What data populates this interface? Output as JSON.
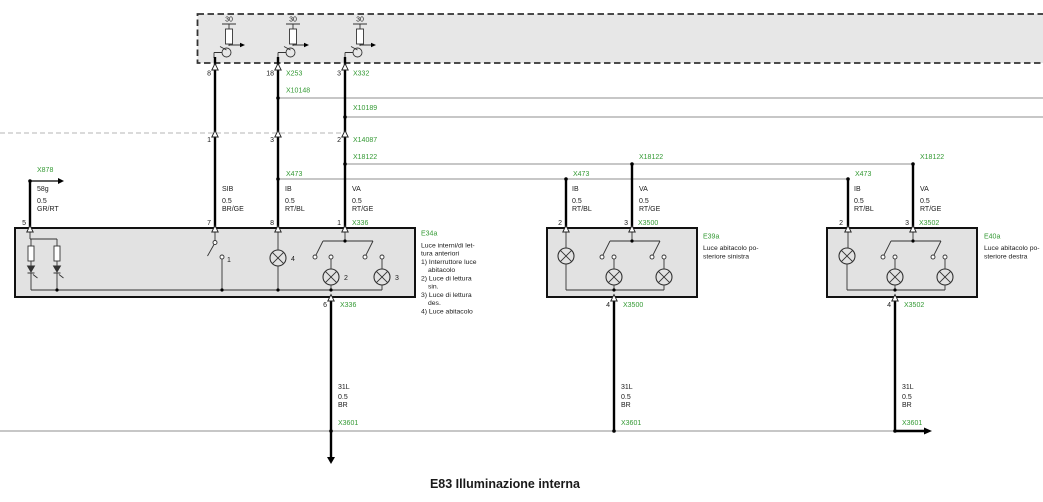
{
  "title": "E83 Illuminazione interna",
  "colors": {
    "connector_label_green": "#339933",
    "component_box_fill": "#e2e2e2",
    "supply_box_fill": "#e7e7e7",
    "bus_line_gray": "#8f8f8f"
  },
  "supply_box": {
    "fuses": [
      {
        "rating": "30",
        "pin": "8"
      },
      {
        "rating": "30",
        "pin": "18",
        "connector": "X253"
      },
      {
        "rating": "30",
        "pin": "3",
        "connector": "X332"
      }
    ]
  },
  "connectors": {
    "x10148": "X10148",
    "x10189": "X10189",
    "x14087": "X14087",
    "x18122": "X18122",
    "x473": "X473",
    "x878": "X878",
    "x3601": "X3601"
  },
  "crossing_pins": {
    "wire1": "1",
    "wire2": "3",
    "wire3": "2"
  },
  "wire_labels": {
    "sib": {
      "circuit": "SIB",
      "gauge": "0.5",
      "color": "BR/GE"
    },
    "ib": {
      "circuit": "IB",
      "gauge": "0.5",
      "color": "RT/BL"
    },
    "va": {
      "circuit": "VA",
      "gauge": "0.5",
      "color": "RT/GE"
    },
    "terminal58g": {
      "circuit": "58g",
      "gauge": "0.5",
      "color": "GR/RT"
    },
    "ground": {
      "circuit": "31L",
      "gauge": "0.5",
      "color": "BR"
    }
  },
  "components": {
    "e34a": {
      "id": "E34a",
      "pins_top": [
        "5",
        "7",
        "8",
        "1"
      ],
      "pin_bottom": "6",
      "top_connector": "X336",
      "bottom_connector": "X336",
      "part_numbers": {
        "switch": "1",
        "lamp2": "2",
        "lamp3": "3",
        "lamp4": "4"
      },
      "description": [
        "Luce interni/di let-",
        "tura anteriori",
        "1) Interruttore luce",
        "abitacolo",
        "2) Luce di lettura",
        "sin.",
        "3) Luce di lettura",
        "des.",
        "4) Luce abitacolo"
      ]
    },
    "e39a": {
      "id": "E39a",
      "pins_top": [
        "2",
        "3"
      ],
      "pin_bottom": "4",
      "connector": "X3500",
      "description": [
        "Luce abitacolo po-",
        "steriore sinistra"
      ]
    },
    "e40a": {
      "id": "E40a",
      "pins_top": [
        "2",
        "3"
      ],
      "pin_bottom": "4",
      "connector": "X3502",
      "description": [
        "Luce abitacolo po-",
        "steriore destra"
      ]
    }
  }
}
